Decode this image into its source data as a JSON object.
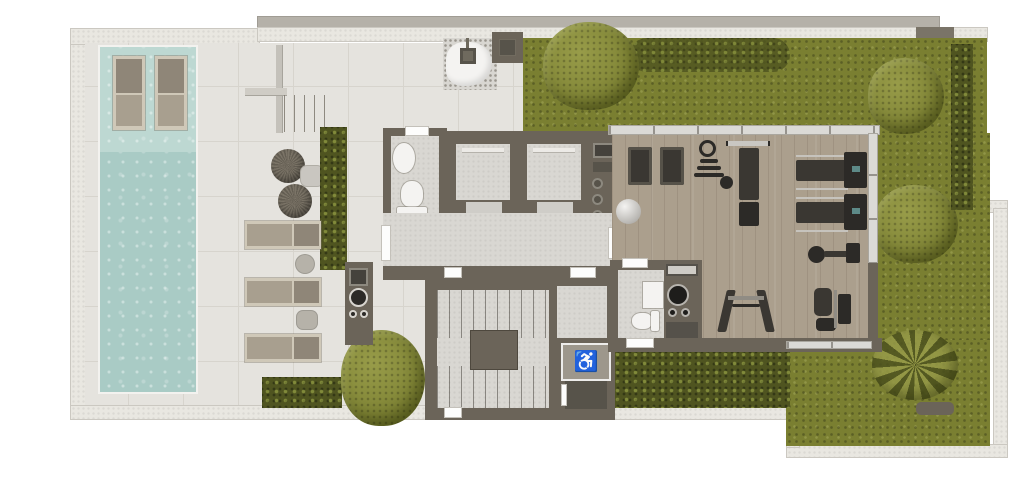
{
  "plan_title": "rooftop-amenity-floor-plan",
  "accessible_symbol": "♿",
  "palette": {
    "wall_light": "#e9e7e1",
    "wall_edge": "#cbc8c1",
    "wall_gray": "#b5b1a9",
    "wall_lintel": "#7a7468",
    "deck": "#e5e3de",
    "tile_line": "#d7d4cd",
    "lawn": "#7a7f31",
    "hedge": "#4f5420",
    "tree_light": "#989c49",
    "pool_shelf": "#bdd8d2",
    "pool_main": "#a9cbc5",
    "core_wall": "#6b6459",
    "interior": "#d9d7d2",
    "fixture_white": "#f4f3f1",
    "frame_light": "#cfc8b8",
    "seat_taupe": "#a89f8f",
    "back_taupe": "#8f8678",
    "pouf_a": "#7b7467",
    "pouf_b": "#645e53",
    "wood": "#ab9f8d",
    "glass": "#dbdad6",
    "equip_dark": "#3a3732",
    "equip_darker": "#2c2a27",
    "screen_teal": "#5d8a88",
    "ball_light": "#f4f3f1"
  },
  "areas": {
    "pool": "pool_main",
    "sun_deck": "deck",
    "gym": "wood",
    "gardens": "lawn",
    "stair_core": "core_wall",
    "elevators": "interior"
  }
}
